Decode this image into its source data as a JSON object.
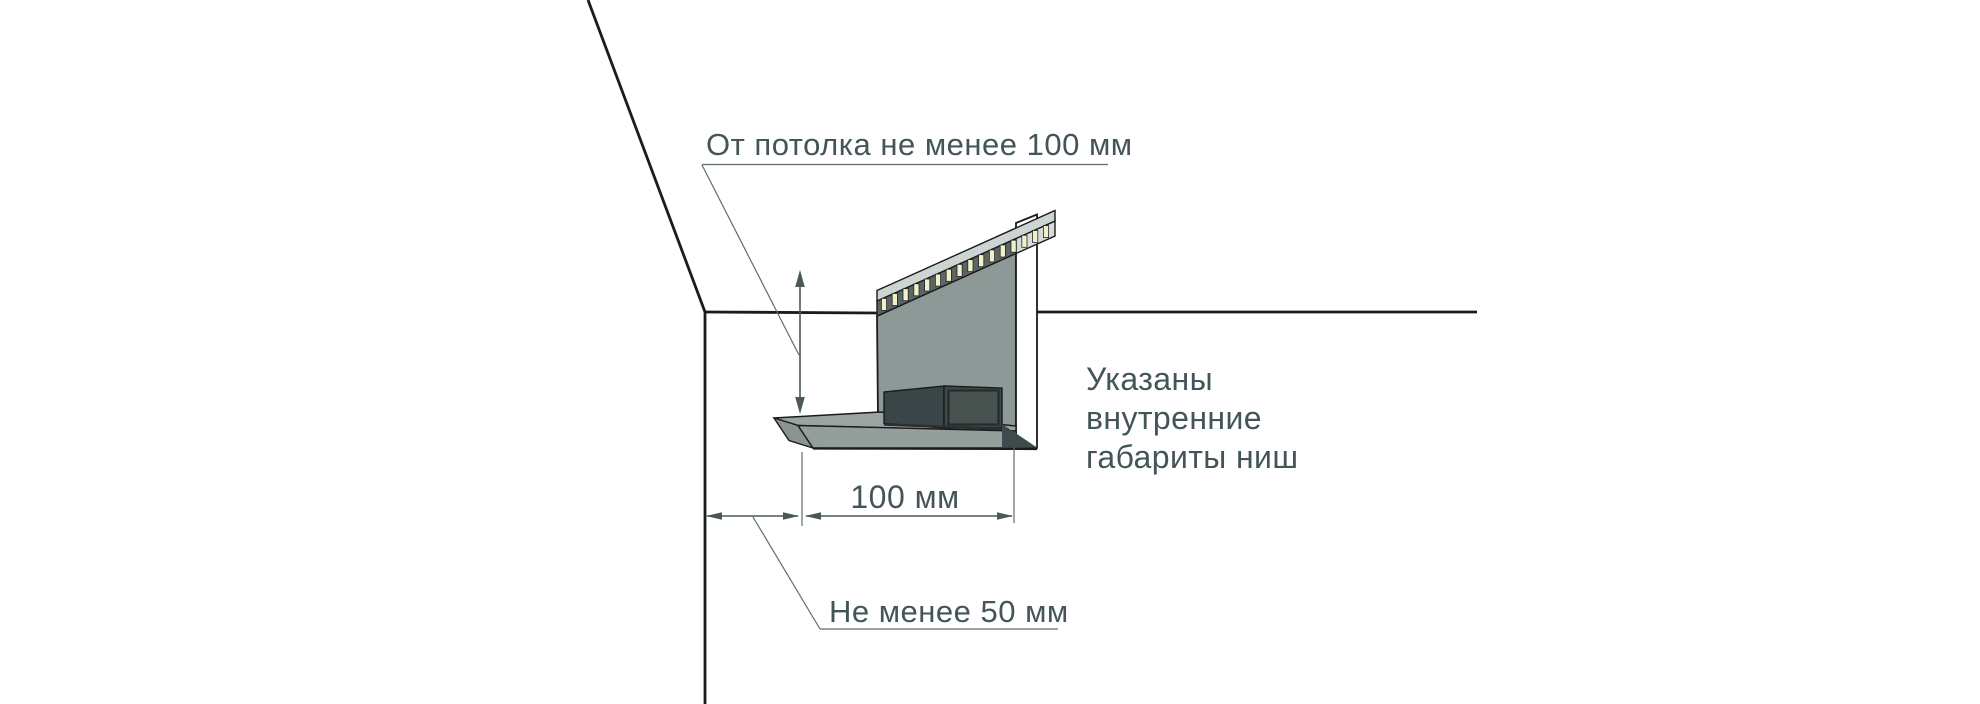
{
  "labels": {
    "ceiling_offset": "От потолка не менее 100 мм",
    "niche_width": "100 мм",
    "wall_offset": "Не менее 50 мм"
  },
  "note": {
    "line1": "Указаны",
    "line2": "внутренние",
    "line3": "габариты ниш"
  },
  "diagram": {
    "subject": "ceiling-led-niche-section",
    "led_count": 16
  },
  "colors": {
    "text": "#445559",
    "dimension": "#4a585c",
    "leader": "#5e6c70",
    "outline": "#1b1b1b",
    "panel": "#8d9996",
    "shelf_top": "#9aa5a2",
    "shelf_front": "#949f9c",
    "shelf_end": "#8a9592",
    "box_front": "#3e494b",
    "box_side": "#3a4548",
    "box_inset": "#48534f",
    "strip_top": "#cdd5d3",
    "strip_front_dark": "#5b6563",
    "strip_front_light": "#d7dcda",
    "led": "#f3efc6",
    "background": "#ffffff"
  }
}
